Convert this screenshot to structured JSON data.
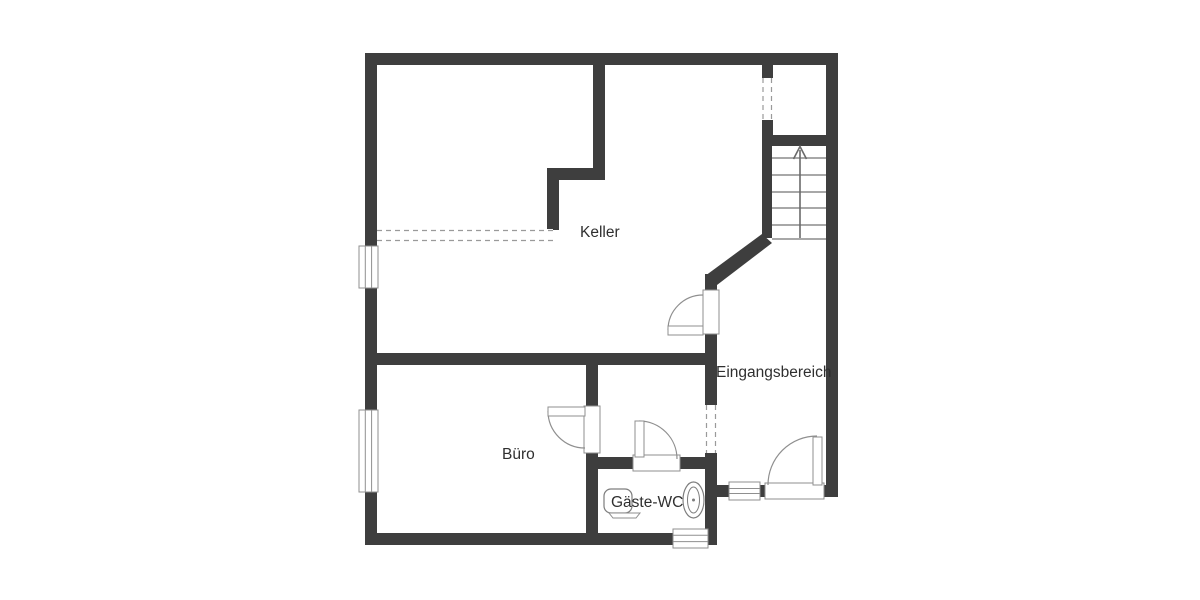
{
  "floorplan": {
    "colors": {
      "wall": "#3e3e3e",
      "line": "#8c8c8c",
      "arrow": "#6a6a6a",
      "text": "#2f2f2f",
      "background": "#ffffff"
    },
    "rooms": [
      {
        "name": "Keller"
      },
      {
        "name": "Eingangsbereich"
      },
      {
        "name": "Büro"
      },
      {
        "name": "Gäste-WC"
      }
    ],
    "stairs": {
      "steps": 7,
      "direction": "up"
    },
    "fixtures": [
      {
        "name": "toilet"
      },
      {
        "name": "washbasin"
      }
    ]
  }
}
